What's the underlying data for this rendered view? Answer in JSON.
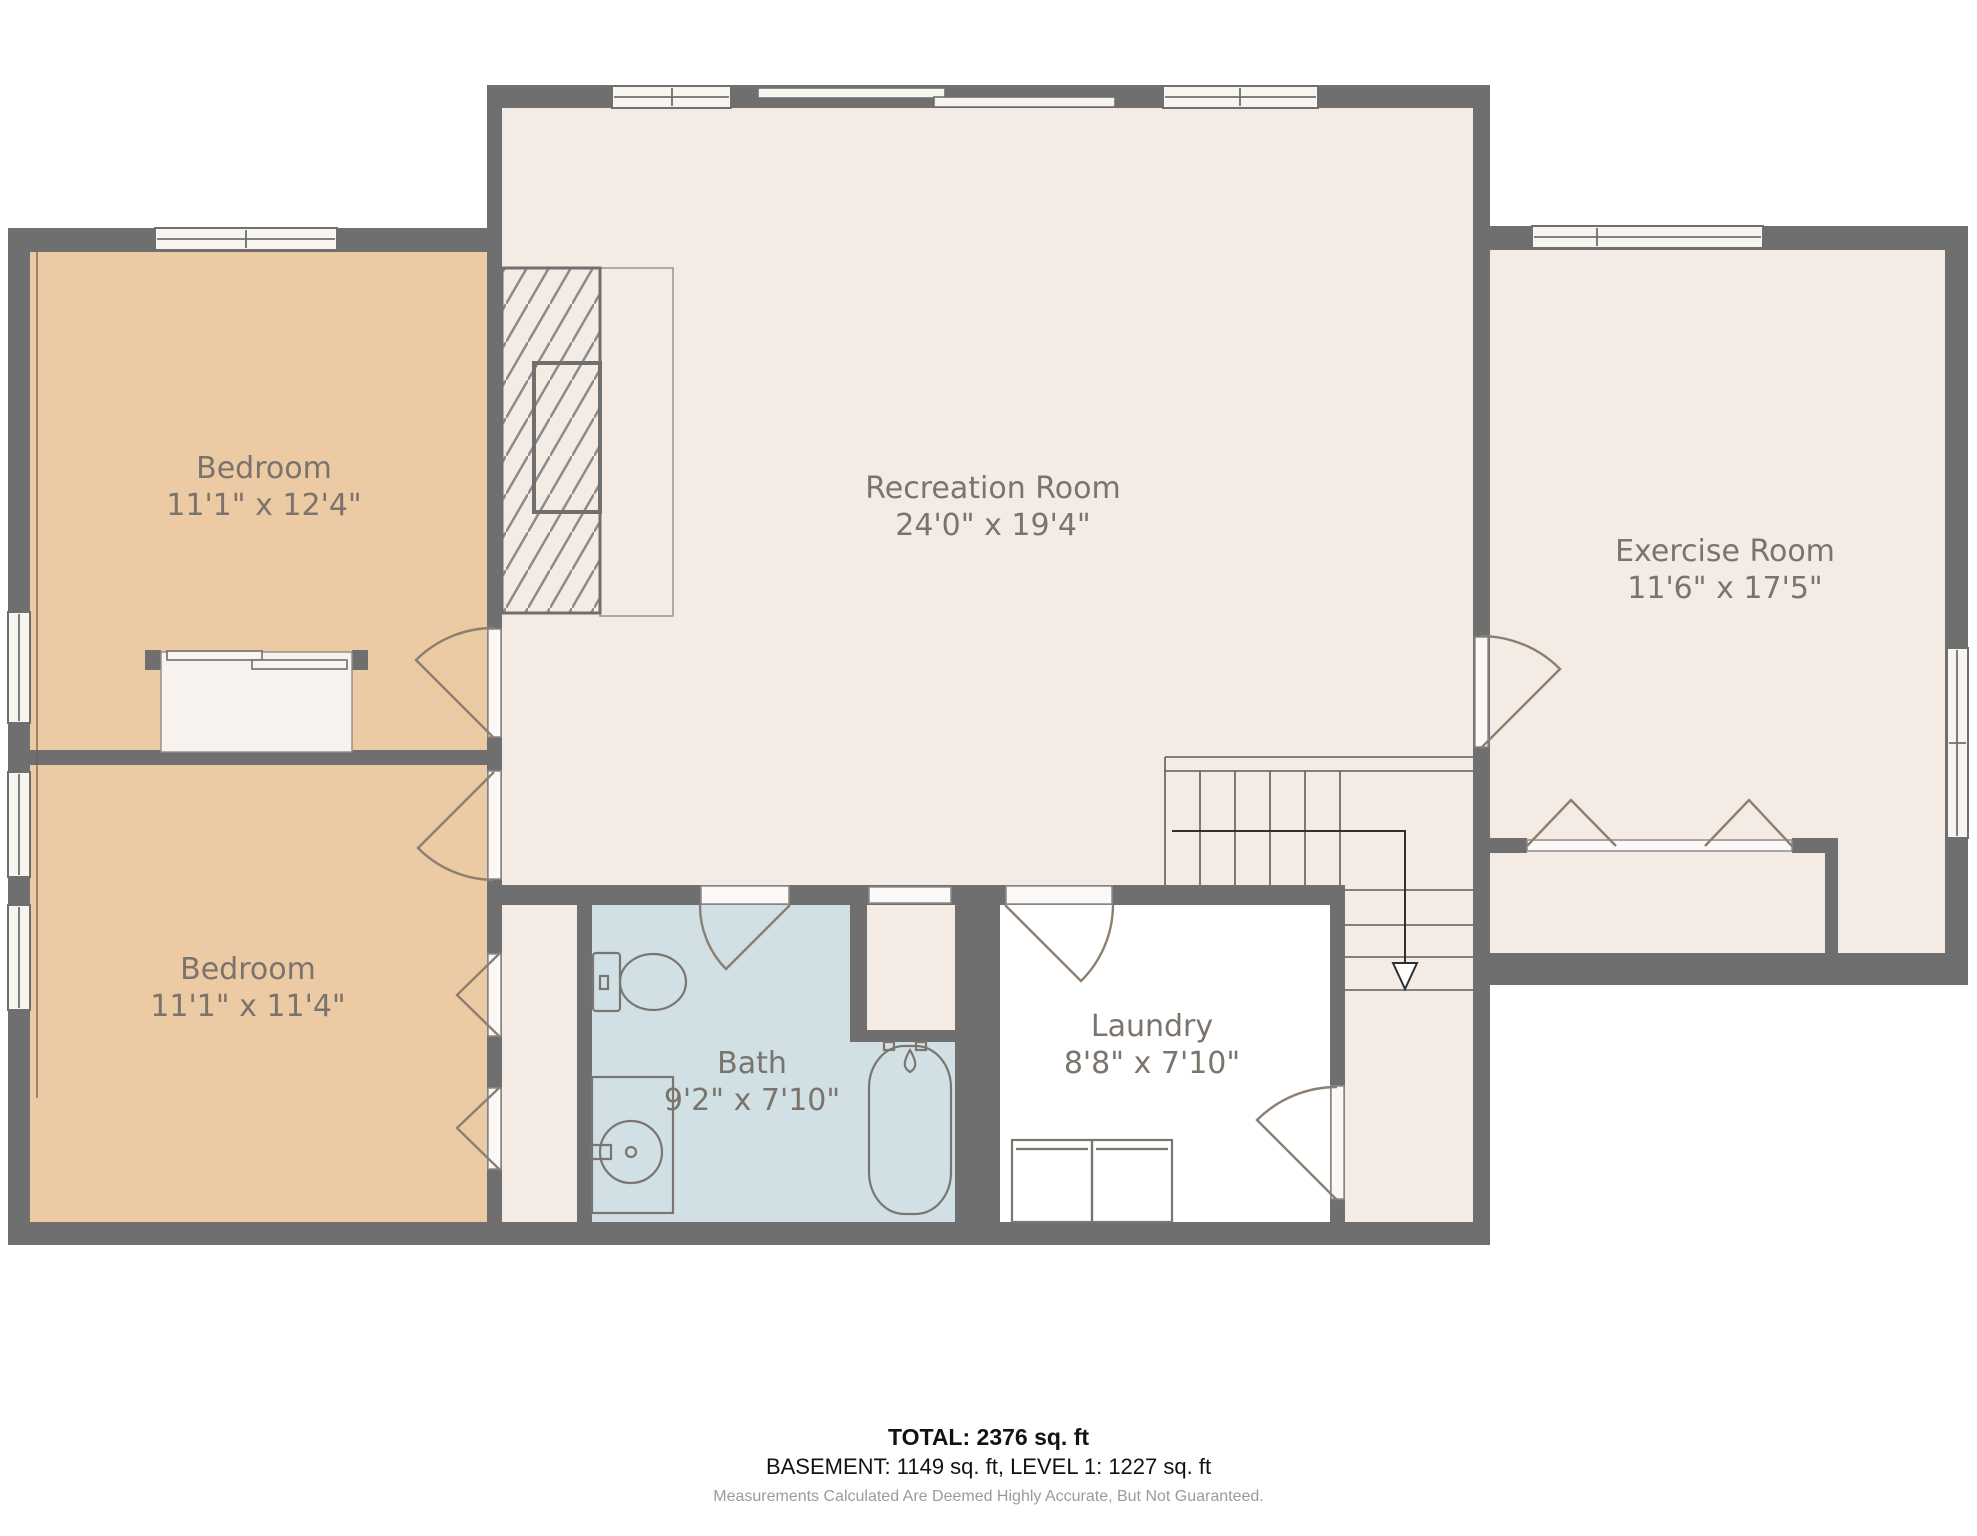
{
  "colors": {
    "c-wall": "#6f6f6f",
    "c-floor": "#f4ebe5",
    "c-bedroom": "#eccaa3",
    "c-bath": "#d0e0e4",
    "c-label": "#7b746d",
    "c-door": "#8c7f71",
    "c-fixture": "#7a766f"
  },
  "rooms": [
    {
      "name": "Bedroom",
      "dims": "11'1\" x 12'4\""
    },
    {
      "name": "Bedroom",
      "dims": "11'1\" x 11'4\""
    },
    {
      "name": "Recreation Room",
      "dims": "24'0\" x 19'4\""
    },
    {
      "name": "Exercise Room",
      "dims": "11'6\" x 17'5\""
    },
    {
      "name": "Bath",
      "dims": "9'2\" x 7'10\""
    },
    {
      "name": "Laundry",
      "dims": "8'8\" x 7'10\""
    }
  ],
  "fixtures": [
    "fireplace",
    "hearth",
    "stairs-down-arrow",
    "toilet",
    "sink-vanity",
    "bathtub",
    "washer-dryer",
    "closet-sliding-doors",
    "bifold-doors",
    "sliding-patio-door",
    "windows",
    "swing-doors"
  ],
  "footer": {
    "total": "TOTAL: 2376 sq. ft",
    "levels": "BASEMENT: 1149 sq. ft, LEVEL 1: 1227 sq. ft",
    "disclaimer": "Measurements Calculated Are Deemed Highly Accurate, But Not Guaranteed."
  }
}
